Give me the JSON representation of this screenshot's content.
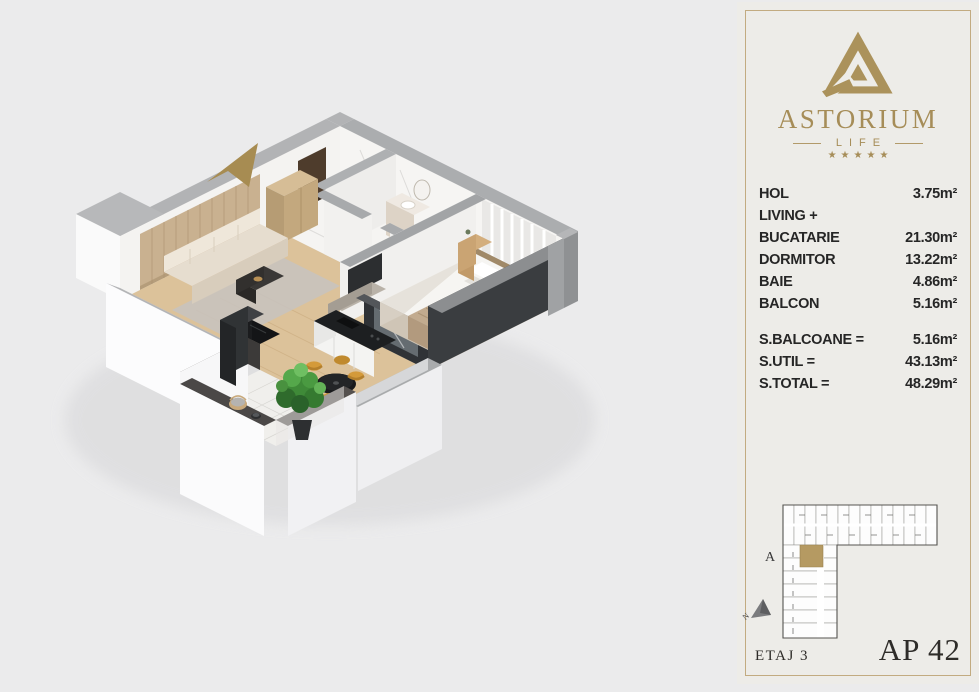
{
  "panel": {
    "background": "#EDECE8",
    "border_color": "#C2AB81",
    "brand": {
      "name": "ASTORIUM",
      "tagline": "LIFE",
      "stars": "★★★★★",
      "gold": "#A68D58"
    },
    "rooms": [
      {
        "label": "HOL",
        "value": "3.75m²"
      },
      {
        "label": "LIVING +",
        "value": ""
      },
      {
        "label": "BUCATARIE",
        "value": "21.30m²"
      },
      {
        "label": "DORMITOR",
        "value": "13.22m²"
      },
      {
        "label": "BAIE",
        "value": "4.86m²"
      },
      {
        "label": "BALCON",
        "value": "5.16m²"
      }
    ],
    "totals": [
      {
        "label": "S.BALCOANE =",
        "value": "5.16m²"
      },
      {
        "label": "S.UTIL =",
        "value": "43.13m²"
      },
      {
        "label": "S.TOTAL =",
        "value": "48.29m²"
      }
    ],
    "site_plan": {
      "block_label": "A",
      "north_label": "N",
      "highlight_color": "#B59A62"
    },
    "footer": {
      "floor": "ETAJ 3",
      "apartment": "AP 42"
    }
  },
  "floor_plan": {
    "colors": {
      "arrow_gold": "#A78C52",
      "wall_top": "#ABADAF",
      "wall_face": "#F6F5F3",
      "dark_wall": "#3A3D40",
      "wood_floor": "#DCC29A",
      "bedroom_floor": "#E3CBA4",
      "marble_floor": "#F5F4F2",
      "balcony_tile": "#F0EFEC",
      "accent_wood": "#C9B190",
      "plant_green": "#3F8A38"
    }
  }
}
